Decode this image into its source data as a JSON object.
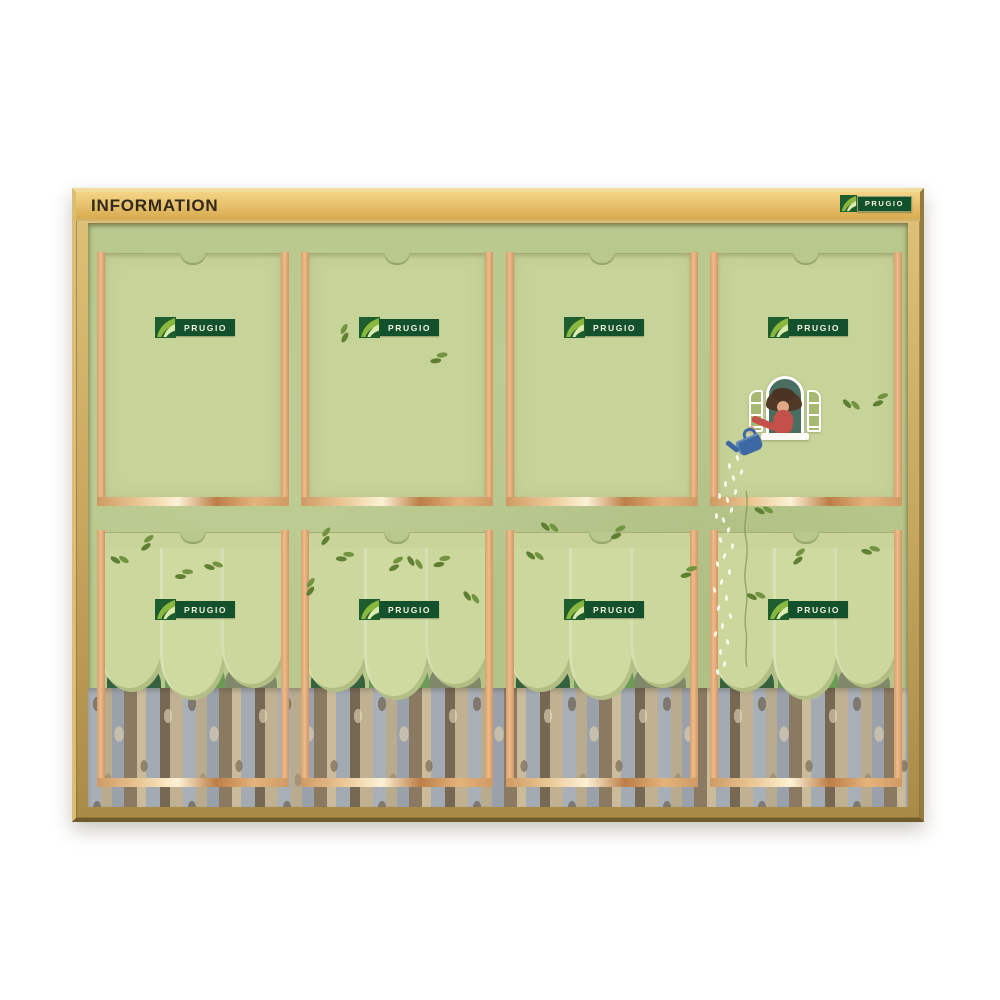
{
  "header": {
    "title": "INFORMATION"
  },
  "brand": {
    "name": "PRUGIO",
    "plate_color": "#12512b",
    "mark_green": "#1e5e2e",
    "mark_leaf": "#8ab83e"
  },
  "board": {
    "panel_rows": 2,
    "panel_columns": 4,
    "frame_gold": "#c9a75e",
    "header_gold": "#e9c46d",
    "backing_green": "#b9c98d",
    "paper_green": "#c6d399",
    "rail_copper": "#e2ab79",
    "rail_shine": "#fdf2d6"
  },
  "illustration": {
    "window": {
      "frame": "#ffffff",
      "interior": "#4a6d61",
      "shutters": "#a6b871"
    },
    "person": {
      "hair": "#4a3322",
      "shirt": "#c4504a",
      "skin": "#e0a887"
    },
    "watering_can_color": "#3c68a4",
    "forest": {
      "crown_green": "#cbd79c",
      "bush_dark": "#36613f",
      "bush_mid": "#6b9b55",
      "bush_olive": "#80886a",
      "trunk_gray": "#a8afb6",
      "trunk_brown": "#8a7a62",
      "trunk_tan": "#c0b193"
    }
  },
  "decor": {
    "leaf_color": "#5f7f33",
    "leaves": [
      [
        252,
        118
      ],
      [
        342,
        136
      ],
      [
        757,
        175
      ],
      [
        784,
        180
      ],
      [
        24,
        332
      ],
      [
        52,
        325
      ],
      [
        117,
        340
      ],
      [
        232,
        320
      ],
      [
        248,
        333
      ],
      [
        322,
        332
      ],
      [
        345,
        340
      ],
      [
        455,
        298
      ],
      [
        522,
        313
      ],
      [
        668,
        283
      ],
      [
        704,
        339
      ],
      [
        774,
        325
      ],
      [
        217,
        371
      ],
      [
        87,
        351
      ],
      [
        378,
        367
      ],
      [
        592,
        351
      ],
      [
        440,
        327
      ],
      [
        300,
        345
      ],
      [
        660,
        369
      ]
    ],
    "water_drops": [
      [
        648,
        232
      ],
      [
        640,
        240
      ],
      [
        652,
        246
      ],
      [
        644,
        252
      ],
      [
        636,
        258
      ],
      [
        646,
        266
      ],
      [
        638,
        274
      ],
      [
        630,
        270
      ],
      [
        642,
        284
      ],
      [
        634,
        294
      ],
      [
        627,
        290
      ],
      [
        639,
        304
      ],
      [
        631,
        314
      ],
      [
        643,
        320
      ],
      [
        635,
        330
      ],
      [
        628,
        338
      ],
      [
        640,
        346
      ],
      [
        632,
        356
      ],
      [
        625,
        364
      ],
      [
        637,
        372
      ],
      [
        629,
        382
      ],
      [
        641,
        390
      ],
      [
        633,
        400
      ],
      [
        626,
        408
      ],
      [
        638,
        416
      ],
      [
        631,
        426
      ],
      [
        635,
        438
      ],
      [
        628,
        446
      ]
    ]
  }
}
